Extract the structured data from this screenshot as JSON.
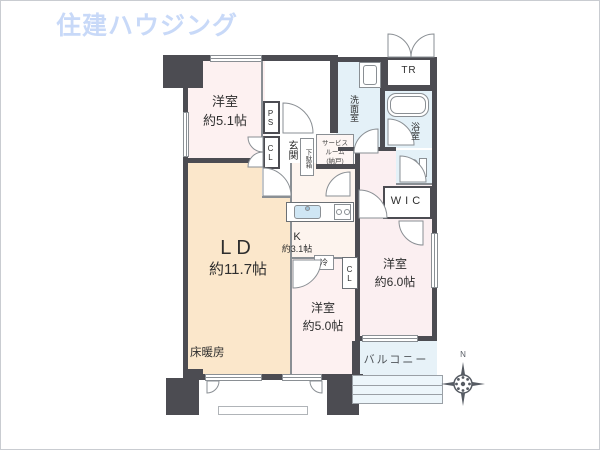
{
  "logo": {
    "text": "住建ハウジング",
    "color": "#c8d9f8"
  },
  "rooms": {
    "bedroom1": {
      "name": "洋室",
      "size": "約5.1帖"
    },
    "living_dining": {
      "name": "LD",
      "size": "約11.7帖",
      "floor_heating": "床暖房"
    },
    "kitchen": {
      "name": "K",
      "size": "約3.1帖"
    },
    "bedroom2": {
      "name": "洋室",
      "size": "約5.0帖"
    },
    "bedroom3": {
      "name": "洋室",
      "size": "約6.0帖"
    },
    "service_room": {
      "line1": "サービス",
      "line2": "ルーム",
      "line3": "(納戸)"
    },
    "entrance": {
      "name": "玄関"
    },
    "shoe_cabinet": {
      "name": "下駄箱"
    },
    "washroom": {
      "name": "洗面室"
    },
    "bathroom": {
      "name": "浴室"
    },
    "balcony": {
      "name": "バルコニー"
    },
    "wic": {
      "name": "WIC"
    },
    "trunk_room": {
      "name": "TR"
    },
    "pipe_space": {
      "name": "PS"
    },
    "closet_hall": {
      "name": "CL"
    },
    "closet_kitchen": {
      "name": "CL"
    },
    "refrigerator": {
      "name": "冷"
    }
  },
  "compass": {
    "north_label": "N"
  },
  "colors": {
    "wall": "#4c4c52",
    "bedroom_fill": "#fdf1f1",
    "living_fill": "#fbe7cb",
    "kitchen_fill": "#fdf4ee",
    "wet_area_fill": "#e4f1f8",
    "logo_blue": "#c8d9f8"
  }
}
